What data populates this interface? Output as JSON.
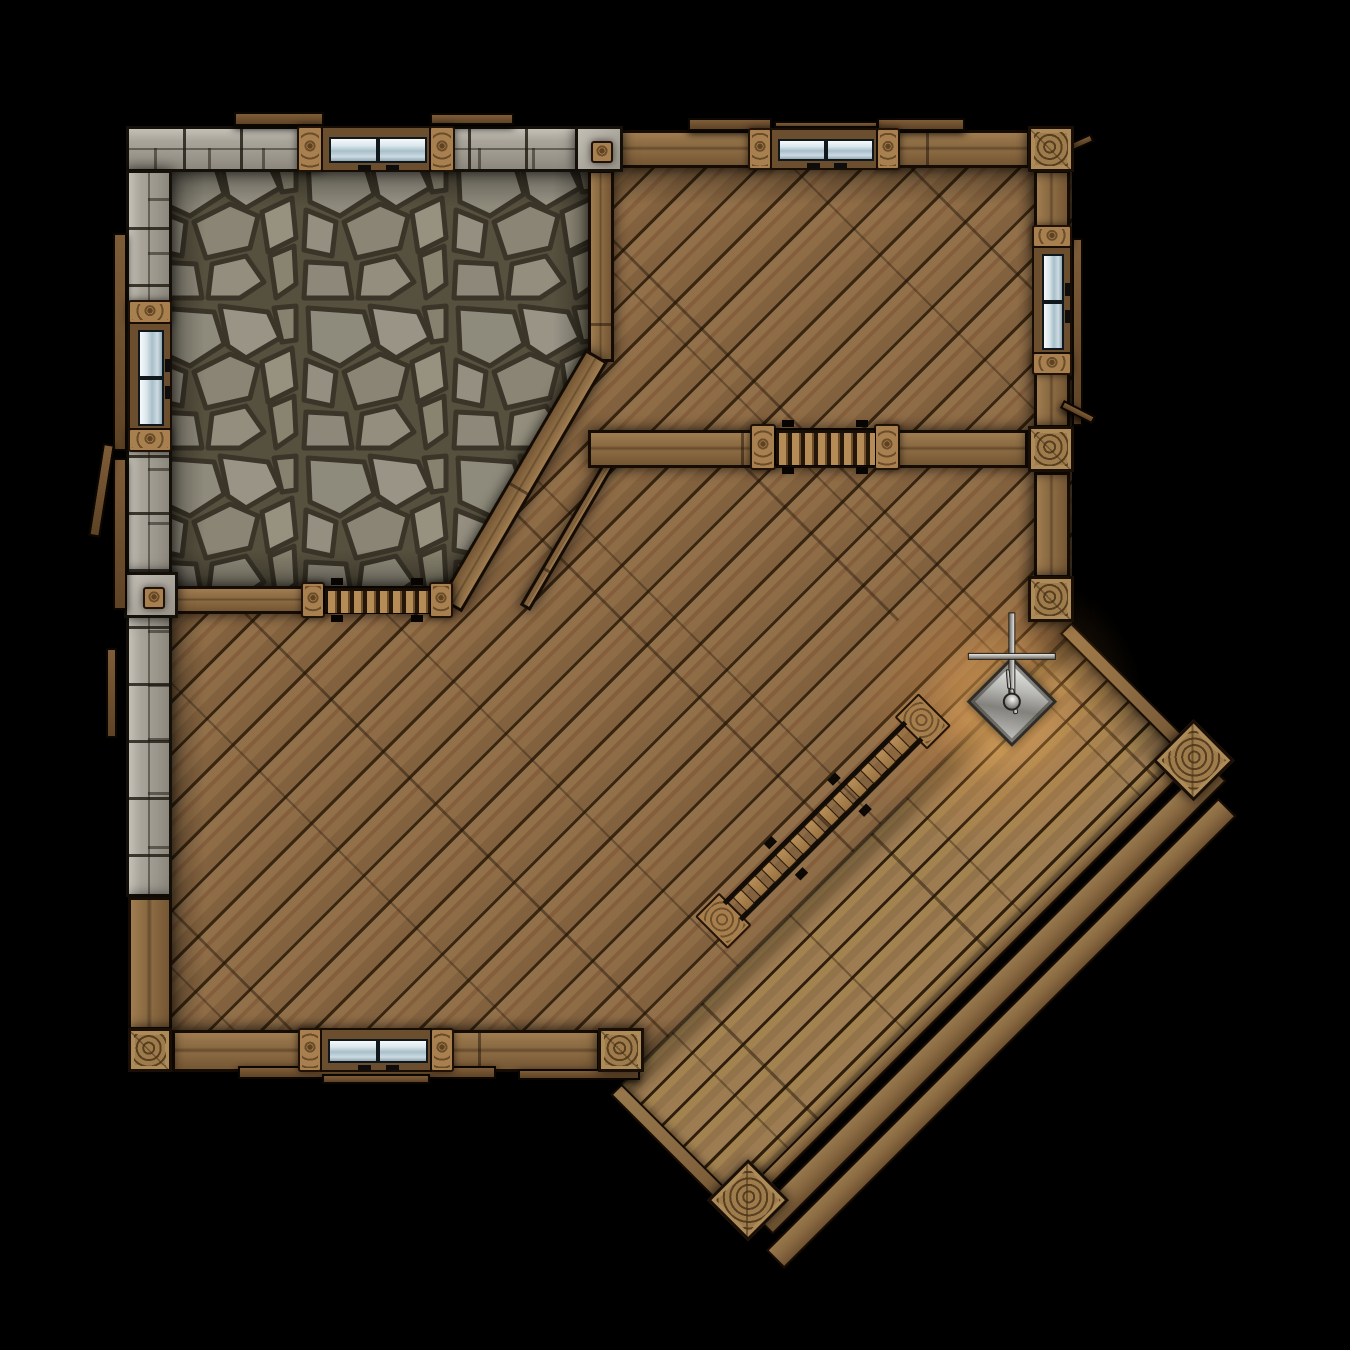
{
  "scene": {
    "canvas": {
      "w": 1350,
      "h": 1350
    },
    "background": "#000000",
    "palette": {
      "wood_floor": "#8b6945",
      "deck_floor": "#9c7b4e",
      "wood_wall": "#8a6a42",
      "stone_wall": "#a8a49a",
      "flagstone": "#8f8b7c",
      "glass": "#cddbe2",
      "lantern_metal": "#b9b9b6",
      "glow": "#ffb050",
      "outline": "#150c04"
    },
    "elements": [
      {
        "kind": "floor-wood",
        "name": "main-hall-floor",
        "x": 150,
        "y": 150,
        "w": 922,
        "h": 922,
        "clip": "polygon(0px 0px, 922px 0px, 922px 511px, 511px 922px, 0px 922px)"
      },
      {
        "kind": "shade",
        "name": "main-hall-floor-shading",
        "x": 150,
        "y": 150,
        "w": 922,
        "h": 922,
        "clip": "polygon(0px 0px, 922px 0px, 922px 511px, 511px 922px, 0px 922px)"
      },
      {
        "kind": "floor-stone",
        "name": "stone-room-floor",
        "x": 150,
        "y": 152,
        "w": 458,
        "h": 452,
        "clip": "polygon(0px 0px, 458px 0px, 458px 206px, 310px 452px, 0px 452px)"
      },
      {
        "kind": "shade",
        "name": "stone-room-floor-shading",
        "x": 150,
        "y": 152,
        "w": 458,
        "h": 452,
        "clip": "polygon(0px 0px, 458px 0px, 458px 206px, 310px 452px, 0px 452px)"
      },
      {
        "kind": "seam",
        "name": "floor-plank-seam",
        "x": 745,
        "y": 465,
        "len": 218,
        "rot": 45
      },
      {
        "kind": "deck",
        "name": "porch-deck",
        "x": 1067,
        "y": 638,
        "rot": 45,
        "w": 178,
        "len": 636,
        "parts": [
          {
            "kind": "deck-floor",
            "name": "deck-floor",
            "x": 0,
            "y": 0,
            "w": 178,
            "h": 636
          },
          {
            "kind": "deck-shade",
            "name": "deck-floor-shading",
            "x": 0,
            "y": 0,
            "w": 178,
            "h": 636
          },
          {
            "kind": "beam",
            "name": "deck-edge-beam-ne",
            "x": -8,
            "y": -14,
            "w": 192,
            "h": 16
          },
          {
            "kind": "beam",
            "name": "deck-edge-beam-se",
            "x": 163,
            "y": -6,
            "w": 15,
            "h": 648
          },
          {
            "kind": "beam",
            "name": "deck-edge-beam-sw",
            "x": 0,
            "y": 630,
            "w": 180,
            "h": 16
          },
          {
            "kind": "beam",
            "name": "deck-step-board-inner",
            "x": 186,
            "y": -12,
            "w": 28,
            "h": 642
          },
          {
            "kind": "beam",
            "name": "deck-step-board-outer",
            "x": 220,
            "y": 6,
            "w": 26,
            "h": 640
          },
          {
            "kind": "edge-line",
            "name": "deck-junction-line",
            "x": -2,
            "y": 0,
            "w": 4,
            "h": 636
          },
          {
            "kind": "glow",
            "name": "lantern-glow-outer",
            "cx": 0,
            "cy": 100,
            "r": 150,
            "color": "rgba(255,158,64,0.30)"
          },
          {
            "kind": "glow",
            "name": "lantern-glow-inner",
            "cx": 2,
            "cy": 95,
            "r": 80,
            "color": "rgba(255,196,110,0.50)"
          },
          {
            "kind": "ring-post",
            "name": "deck-corner-post-east",
            "x": 147,
            "y": -32,
            "w": 58,
            "h": 58
          },
          {
            "kind": "ring-post",
            "name": "deck-corner-post-south",
            "x": 143,
            "y": 594,
            "w": 58,
            "h": 58
          },
          {
            "kind": "ladder",
            "name": "stairs-ladder",
            "x": -66,
            "y": 144,
            "w": 46,
            "len": 316,
            "rungs": 12
          },
          {
            "kind": "lantern",
            "name": "hanging-lantern",
            "x": -26,
            "y": 52,
            "s": 64
          }
        ]
      },
      {
        "kind": "wall-stone-h",
        "name": "outer-wall-north-stone",
        "x": 126,
        "y": 126,
        "w": 452,
        "h": 46
      },
      {
        "kind": "wall-stone-v",
        "name": "outer-wall-west-stone",
        "x": 126,
        "y": 170,
        "w": 46,
        "h": 727
      },
      {
        "kind": "wall-wood-h",
        "name": "outer-wall-north-wood",
        "x": 620,
        "y": 130,
        "w": 410,
        "h": 38
      },
      {
        "kind": "wall-wood-v",
        "name": "outer-wall-west-wood",
        "x": 128,
        "y": 897,
        "w": 44,
        "h": 133
      },
      {
        "kind": "wall-wood-v",
        "name": "outer-wall-east-upper",
        "x": 1034,
        "y": 170,
        "w": 36,
        "h": 258
      },
      {
        "kind": "wall-wood-v",
        "name": "outer-wall-east-lower",
        "x": 1034,
        "y": 472,
        "w": 36,
        "h": 106
      },
      {
        "kind": "wall-wood-h",
        "name": "outer-wall-south",
        "x": 172,
        "y": 1030,
        "w": 428,
        "h": 42
      },
      {
        "kind": "wall-wood-v",
        "name": "stone-room-east-wall",
        "x": 588,
        "y": 170,
        "w": 26,
        "h": 192
      },
      {
        "kind": "wall-wood-r",
        "name": "stone-room-chamfer-wall",
        "x": 608,
        "y": 362,
        "w": 290,
        "h": 26,
        "rot": 120.3
      },
      {
        "kind": "wall-wood-r",
        "name": "chamfer-outer-beam",
        "x": 630,
        "y": 440,
        "w": 198,
        "h": 12,
        "rot": 120.3
      },
      {
        "kind": "wall-wood-h",
        "name": "stone-room-south-wall",
        "x": 172,
        "y": 586,
        "w": 280,
        "h": 28
      },
      {
        "kind": "wall-wood-h",
        "name": "upper-room-partition-wall",
        "x": 588,
        "y": 430,
        "w": 440,
        "h": 38
      },
      {
        "kind": "stone-block",
        "name": "wall-junction-block-north",
        "x": 575,
        "y": 126,
        "w": 48,
        "h": 46,
        "knot": true
      },
      {
        "kind": "stone-block",
        "name": "wall-junction-block-west",
        "x": 124,
        "y": 572,
        "w": 54,
        "h": 46,
        "knot": true
      },
      {
        "kind": "eave",
        "name": "roof-board-north-1",
        "x": 234,
        "y": 112,
        "w": 90,
        "h": 14
      },
      {
        "kind": "eave",
        "name": "roof-board-north-2",
        "x": 430,
        "y": 113,
        "w": 84,
        "h": 12
      },
      {
        "kind": "eave",
        "name": "roof-board-north-3",
        "x": 688,
        "y": 118,
        "w": 84,
        "h": 13
      },
      {
        "kind": "eave",
        "name": "roof-board-north-4",
        "x": 877,
        "y": 118,
        "w": 88,
        "h": 13
      },
      {
        "kind": "eave",
        "name": "roof-board-north-5",
        "x": 774,
        "y": 121,
        "w": 104,
        "h": 7
      },
      {
        "kind": "eave",
        "name": "roof-board-west-1",
        "x": 113,
        "y": 233,
        "w": 14,
        "h": 218
      },
      {
        "kind": "eave",
        "name": "roof-board-west-2",
        "x": 113,
        "y": 458,
        "w": 14,
        "h": 152
      },
      {
        "kind": "eave",
        "name": "roof-board-west-3",
        "x": 103,
        "y": 443,
        "w": 12,
        "h": 94,
        "rot": 9
      },
      {
        "kind": "eave",
        "name": "roof-board-west-4",
        "x": 106,
        "y": 648,
        "w": 11,
        "h": 90
      },
      {
        "kind": "eave",
        "name": "roof-board-east-1",
        "x": 1072,
        "y": 238,
        "w": 11,
        "h": 188
      },
      {
        "kind": "eave",
        "name": "roof-board-east-2",
        "x": 1058,
        "y": 148,
        "w": 36,
        "h": 9,
        "rot": -24
      },
      {
        "kind": "eave",
        "name": "roof-board-east-3",
        "x": 1064,
        "y": 400,
        "w": 36,
        "h": 9,
        "rot": 27
      },
      {
        "kind": "eave",
        "name": "roof-board-south-1",
        "x": 238,
        "y": 1066,
        "w": 258,
        "h": 13
      },
      {
        "kind": "eave",
        "name": "roof-board-south-2",
        "x": 322,
        "y": 1074,
        "w": 108,
        "h": 10
      },
      {
        "kind": "eave",
        "name": "roof-board-south-3",
        "x": 518,
        "y": 1069,
        "w": 122,
        "h": 11
      },
      {
        "kind": "window-h",
        "name": "window-north-west",
        "x": 297,
        "y": 126,
        "w": 158,
        "h": 46,
        "pw": 26
      },
      {
        "kind": "window-h",
        "name": "window-north-east",
        "x": 748,
        "y": 128,
        "w": 152,
        "h": 42,
        "pw": 24
      },
      {
        "kind": "window-v",
        "name": "window-west",
        "x": 128,
        "y": 300,
        "w": 44,
        "h": 152,
        "pw": 24
      },
      {
        "kind": "window-v",
        "name": "window-east",
        "x": 1032,
        "y": 225,
        "w": 40,
        "h": 150,
        "pw": 23
      },
      {
        "kind": "window-h",
        "name": "window-south",
        "x": 298,
        "y": 1028,
        "w": 156,
        "h": 44,
        "pw": 24
      },
      {
        "kind": "shutter-h",
        "name": "shutter-window-partition",
        "x": 750,
        "y": 424,
        "w": 150,
        "h": 46,
        "pw": 26
      },
      {
        "kind": "shutter-h",
        "name": "shutter-window-stone-room",
        "x": 301,
        "y": 582,
        "w": 152,
        "h": 36,
        "pw": 24
      },
      {
        "kind": "ring-post",
        "name": "corner-post-north-east",
        "x": 1028,
        "y": 126,
        "w": 46,
        "h": 46
      },
      {
        "kind": "ring-post",
        "name": "east-wall-junction-post",
        "x": 1028,
        "y": 426,
        "w": 46,
        "h": 46
      },
      {
        "kind": "ring-post",
        "name": "east-wall-end-post",
        "x": 1028,
        "y": 576,
        "w": 46,
        "h": 46
      },
      {
        "kind": "ring-post",
        "name": "corner-post-south-west",
        "x": 128,
        "y": 1028,
        "w": 44,
        "h": 44
      },
      {
        "kind": "ring-post",
        "name": "south-wall-end-post",
        "x": 598,
        "y": 1028,
        "w": 46,
        "h": 44
      }
    ]
  }
}
